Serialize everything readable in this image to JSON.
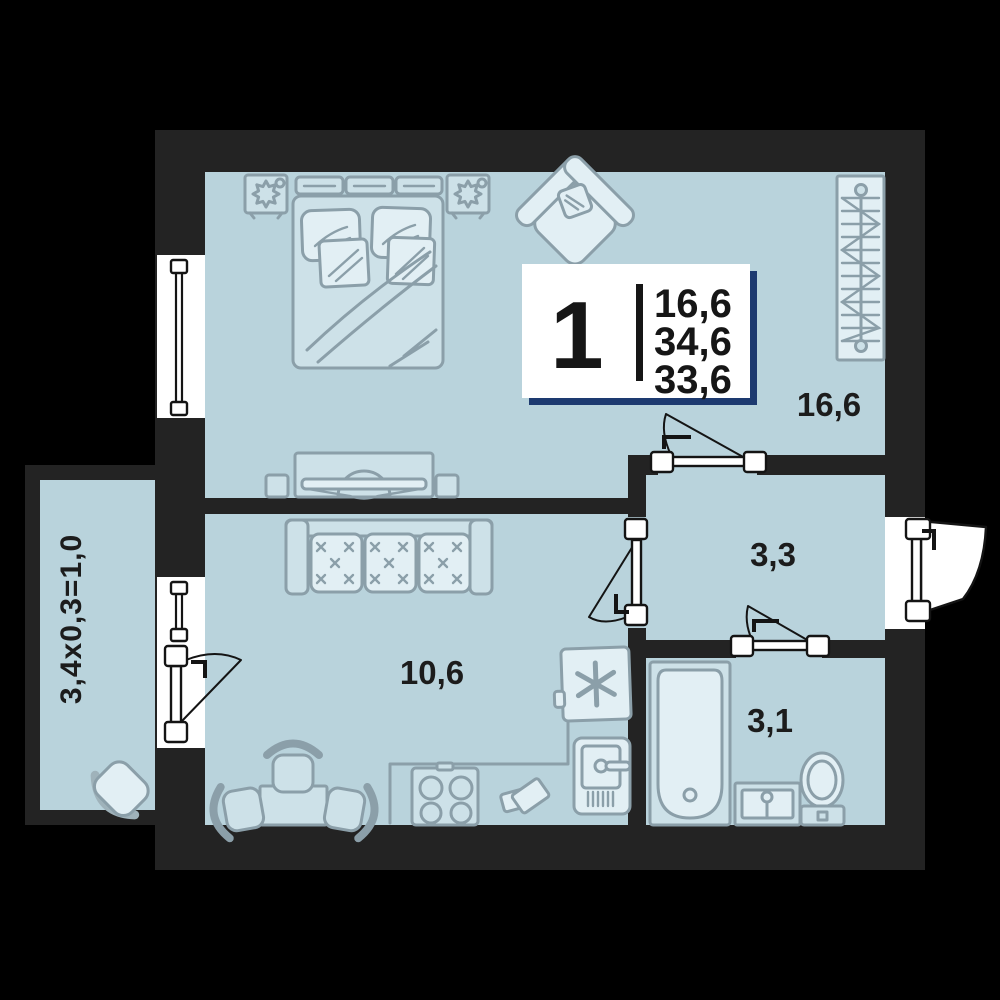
{
  "plan": {
    "type": "apartment-floor-plan",
    "unit_card": {
      "rooms_count": "1",
      "area_line1": "16,6",
      "area_line2": "34,6",
      "area_line3": "33,6"
    },
    "rooms": {
      "living": {
        "name": "living-room",
        "label": "16,6"
      },
      "hall": {
        "name": "hallway",
        "label": "3,3"
      },
      "kitchen": {
        "name": "kitchen",
        "label": "10,6"
      },
      "bathroom": {
        "name": "bathroom",
        "label": "3,1"
      },
      "balcony": {
        "name": "balcony",
        "label": "3,4x0,3=1,0"
      }
    },
    "colors": {
      "background": "#000000",
      "wall": "#232323",
      "floor": "#b9d3dc",
      "furniture_fill": "#cde1e8",
      "furniture_stroke": "#8b9fa9",
      "opening": "#ffffff",
      "card_shadow": "#1d3a70",
      "label_text": "#1c1c1c"
    }
  }
}
